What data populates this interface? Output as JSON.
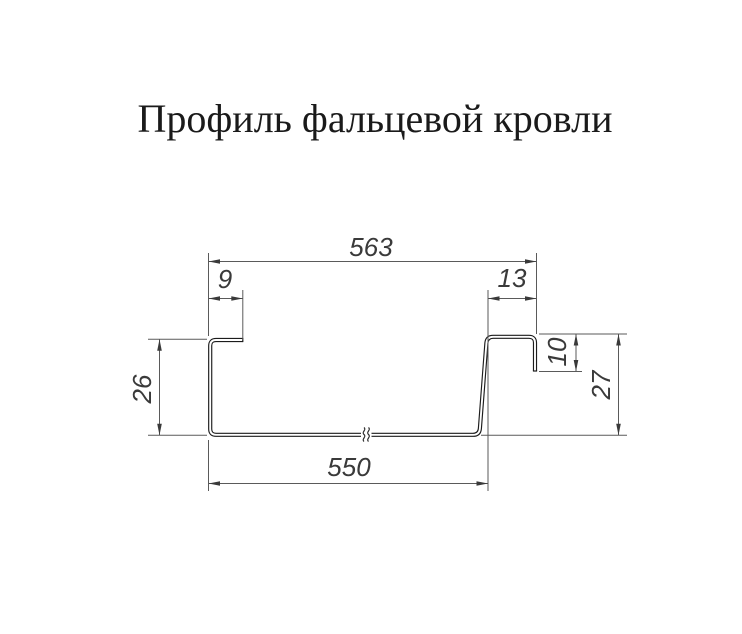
{
  "title": "Профиль фальцевой кровли",
  "drawing": {
    "kind": "falz-roofing-profile-cross-section",
    "line_colors": {
      "profile": "#1c1c1c",
      "dimension": "#5a5a5a",
      "text": "#3a3a3a"
    },
    "dimensions": {
      "top_width": "563",
      "left_flange_width": "9",
      "right_flange_width": "13",
      "right_lip_height": "10",
      "left_height": "26",
      "right_height": "27",
      "bottom_width": "550"
    }
  }
}
